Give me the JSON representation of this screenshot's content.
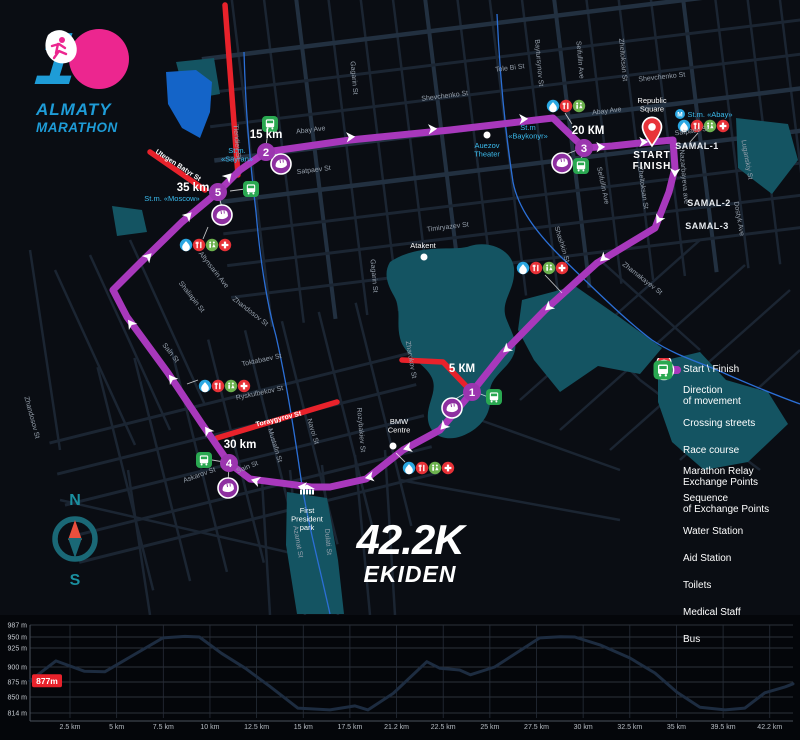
{
  "logo": {
    "number": "1",
    "line1": "ALMATY",
    "line2": "MARATHON"
  },
  "race_title": {
    "distance": "42.2K",
    "name": "EKIDEN"
  },
  "compass": {
    "north": "N",
    "south": "S"
  },
  "legend": {
    "items": [
      {
        "icon": "start-finish-pin",
        "label": "Start \\ Finish"
      },
      {
        "icon": "direction-arrow",
        "label": "Direction\nof movement"
      },
      {
        "icon": "crossing-bar",
        "label": "Crossing streets"
      },
      {
        "icon": "course-bar",
        "label": "Race course"
      },
      {
        "icon": "relay",
        "label": "Marathon Relay\nExchange Points"
      },
      {
        "icon": "sequence",
        "label": "Sequence\nof Exchange Points"
      },
      {
        "icon": "water",
        "label": "Water Station"
      },
      {
        "icon": "aid",
        "label": "Aid Station"
      },
      {
        "icon": "toilets",
        "label": "Toilets"
      },
      {
        "icon": "medical",
        "label": "Medical Staff"
      },
      {
        "icon": "bus",
        "label": "Bus"
      }
    ]
  },
  "map": {
    "start": {
      "x": 652,
      "y": 129,
      "line1": "START",
      "line2": "FINISH"
    },
    "course": {
      "color": "#a838bc",
      "points": [
        [
          673,
          140
        ],
        [
          675,
          168
        ],
        [
          669,
          192
        ],
        [
          655,
          228
        ],
        [
          597,
          263
        ],
        [
          545,
          310
        ],
        [
          503,
          353
        ],
        [
          472,
          392
        ],
        [
          440,
          430
        ],
        [
          403,
          450
        ],
        [
          366,
          479
        ],
        [
          330,
          487
        ],
        [
          311,
          487
        ],
        [
          250,
          479
        ],
        [
          229,
          463
        ],
        [
          202,
          424
        ],
        [
          168,
          373
        ],
        [
          127,
          317
        ],
        [
          113,
          290
        ],
        [
          140,
          263
        ],
        [
          182,
          222
        ],
        [
          218,
          192
        ],
        [
          240,
          170
        ],
        [
          266,
          152
        ],
        [
          350,
          140
        ],
        [
          450,
          130
        ],
        [
          553,
          118
        ],
        [
          584,
          148
        ],
        [
          612,
          146
        ],
        [
          640,
          143
        ],
        [
          673,
          140
        ]
      ],
      "arrows": [
        [
          675,
          172,
          92
        ],
        [
          659,
          219,
          118
        ],
        [
          604,
          258,
          139
        ],
        [
          549,
          307,
          139
        ],
        [
          507,
          349,
          139
        ],
        [
          444,
          426,
          133
        ],
        [
          408,
          448,
          164
        ],
        [
          370,
          477,
          168
        ],
        [
          303,
          487,
          184
        ],
        [
          256,
          481,
          196
        ],
        [
          208,
          431,
          236
        ],
        [
          172,
          379,
          234
        ],
        [
          131,
          324,
          234
        ],
        [
          148,
          257,
          314
        ],
        [
          188,
          216,
          314
        ],
        [
          228,
          177,
          314
        ],
        [
          350,
          137,
          -4
        ],
        [
          432,
          129,
          -4
        ],
        [
          523,
          119,
          -3
        ],
        [
          600,
          147,
          -2
        ],
        [
          643,
          142,
          -1
        ]
      ]
    },
    "crossing_color": "#e8222b",
    "crossing_streets": [
      [
        [
          225,
          5
        ],
        [
          238,
          175
        ]
      ],
      [
        [
          150,
          152
        ],
        [
          205,
          190
        ]
      ],
      [
        [
          402,
          360
        ],
        [
          443,
          362
        ],
        [
          468,
          388
        ]
      ],
      [
        [
          217,
          438
        ],
        [
          337,
          402
        ]
      ]
    ],
    "exchange_points": [
      {
        "n": "1",
        "x": 472,
        "y": 392
      },
      {
        "n": "2",
        "x": 266,
        "y": 152
      },
      {
        "n": "3",
        "x": 584,
        "y": 148
      },
      {
        "n": "4",
        "x": 229,
        "y": 463
      },
      {
        "n": "5",
        "x": 218,
        "y": 192
      }
    ],
    "km_labels": [
      {
        "t": "5 КМ",
        "x": 462,
        "y": 372
      },
      {
        "t": "15 km",
        "x": 266,
        "y": 138
      },
      {
        "t": "20 КМ",
        "x": 588,
        "y": 134
      },
      {
        "t": "30 km",
        "x": 240,
        "y": 448
      },
      {
        "t": "35 km",
        "x": 193,
        "y": 191
      }
    ],
    "relay_points": [
      [
        452,
        408
      ],
      [
        281,
        164
      ],
      [
        562,
        163
      ],
      [
        228,
        488
      ],
      [
        222,
        215
      ]
    ],
    "bus_stops": [
      [
        494,
        397
      ],
      [
        270,
        124
      ],
      [
        581,
        166
      ],
      [
        204,
        460
      ],
      [
        251,
        189
      ]
    ],
    "icon_clusters": [
      {
        "x": 553,
        "y": 106,
        "icons": [
          "water",
          "aid",
          "toilets"
        ]
      },
      {
        "x": 684,
        "y": 126,
        "icons": [
          "water",
          "aid",
          "toilets",
          "medical"
        ]
      },
      {
        "x": 523,
        "y": 268,
        "icons": [
          "water",
          "aid",
          "toilets",
          "medical"
        ]
      },
      {
        "x": 186,
        "y": 245,
        "icons": [
          "water",
          "aid",
          "toilets",
          "medical"
        ]
      },
      {
        "x": 205,
        "y": 386,
        "icons": [
          "water",
          "aid",
          "toilets",
          "medical"
        ]
      },
      {
        "x": 409,
        "y": 468,
        "icons": [
          "water",
          "aid",
          "toilets",
          "medical"
        ]
      }
    ],
    "street_labels": [
      {
        "t": "Tole Bi St",
        "x": 510,
        "y": 70,
        "r": -7
      },
      {
        "t": "Shevchenko St",
        "x": 445,
        "y": 98,
        "r": -7
      },
      {
        "t": "Shevchenko St",
        "x": 662,
        "y": 79,
        "r": -6
      },
      {
        "t": "Abay Ave",
        "x": 311,
        "y": 132,
        "r": -7
      },
      {
        "t": "Abay Ave",
        "x": 607,
        "y": 113,
        "r": -7
      },
      {
        "t": "Satpaev St",
        "x": 314,
        "y": 172,
        "r": -7
      },
      {
        "t": "Satpaev St",
        "x": 692,
        "y": 133,
        "r": -8
      },
      {
        "t": "Timiryazev St",
        "x": 448,
        "y": 229,
        "r": -7
      },
      {
        "t": "Baytursynov St",
        "x": 537,
        "y": 63,
        "r": 85
      },
      {
        "t": "Seifullin Ave",
        "x": 578,
        "y": 60,
        "r": 85
      },
      {
        "t": "Seifullin Ave",
        "x": 601,
        "y": 186,
        "r": 78
      },
      {
        "t": "Zheltoksan St",
        "x": 621,
        "y": 60,
        "r": 85
      },
      {
        "t": "Zheltoksan St",
        "x": 641,
        "y": 188,
        "r": 82
      },
      {
        "t": "Nazarbayeva ave",
        "x": 682,
        "y": 177,
        "r": 85
      },
      {
        "t": "Luganskiy St",
        "x": 745,
        "y": 160,
        "r": 80
      },
      {
        "t": "Dostyk Ave",
        "x": 737,
        "y": 219,
        "r": 80
      },
      {
        "t": "Zhamakayev St",
        "x": 641,
        "y": 280,
        "r": 38
      },
      {
        "t": "Shashkin St",
        "x": 560,
        "y": 245,
        "r": 73
      },
      {
        "t": "Gagarin St",
        "x": 352,
        "y": 78,
        "r": 85
      },
      {
        "t": "Gagarin St",
        "x": 372,
        "y": 276,
        "r": 85
      },
      {
        "t": "Zharokov St",
        "x": 409,
        "y": 360,
        "r": 80
      },
      {
        "t": "Altynsarin Ave",
        "x": 212,
        "y": 271,
        "r": 52
      },
      {
        "t": "Shaliapin St",
        "x": 190,
        "y": 298,
        "r": 52
      },
      {
        "t": "Zhandosov St",
        "x": 249,
        "y": 313,
        "r": 38
      },
      {
        "t": "Zhandosov St",
        "x": 30,
        "y": 418,
        "r": 75
      },
      {
        "t": "Toktabaev St",
        "x": 262,
        "y": 362,
        "r": -12
      },
      {
        "t": "Sain St",
        "x": 169,
        "y": 354,
        "r": 52
      },
      {
        "t": "Sain St",
        "x": 248,
        "y": 469,
        "r": -22
      },
      {
        "t": "Askarov St",
        "x": 200,
        "y": 477,
        "r": -20
      },
      {
        "t": "Ryskulbekov St",
        "x": 260,
        "y": 395,
        "r": -12
      },
      {
        "t": "Mustafin St",
        "x": 273,
        "y": 446,
        "r": 73
      },
      {
        "t": "Navoi St",
        "x": 311,
        "y": 432,
        "r": 73
      },
      {
        "t": "Rozybakiev St",
        "x": 359,
        "y": 430,
        "r": 85
      },
      {
        "t": "Azamat St",
        "x": 296,
        "y": 542,
        "r": 80
      },
      {
        "t": "Dulati St",
        "x": 326,
        "y": 542,
        "r": 85
      },
      {
        "t": "Tlendiev St",
        "x": 235,
        "y": 142,
        "r": 85
      },
      {
        "t": "Utegen Batyr St",
        "x": 177,
        "y": 167,
        "r": 33,
        "red": true
      },
      {
        "t": "Toraygyrov St",
        "x": 279,
        "y": 421,
        "r": -14,
        "red": true
      }
    ],
    "metro_labels": [
      {
        "t": "St.m.\n«Sayran»",
        "x": 237,
        "y": 153
      },
      {
        "t": "St.m. «Moscow»",
        "x": 172,
        "y": 201
      },
      {
        "t": "St.m\n«Baykonyr»",
        "x": 528,
        "y": 130
      },
      {
        "t": "St.m. «Abay»",
        "x": 710,
        "y": 117,
        "mdot": [
          680,
          114
        ]
      },
      {
        "t": "Auezov\nTheater",
        "x": 487,
        "y": 148,
        "wdot": [
          487,
          135
        ]
      }
    ],
    "poi_labels": [
      {
        "t": "Republic\nSquare",
        "x": 652,
        "y": 103
      },
      {
        "t": "Atakent",
        "x": 423,
        "y": 248,
        "wdot": [
          424,
          257
        ]
      },
      {
        "t": "BMW\nCentre",
        "x": 399,
        "y": 424,
        "wdot": [
          393,
          446
        ]
      },
      {
        "t": "First\nPresident\npark",
        "x": 307,
        "y": 513,
        "building": [
          307,
          489
        ]
      }
    ],
    "area_labels": [
      {
        "t": "SAMAL-1",
        "x": 697,
        "y": 149
      },
      {
        "t": "SAMAL-2",
        "x": 709,
        "y": 206
      },
      {
        "t": "SAMAL-3",
        "x": 707,
        "y": 229
      }
    ]
  },
  "chart_data": {
    "type": "line",
    "description": "Elevation profile of the 42.2 km Ekiden course",
    "ylabel": "elevation (m)",
    "xlabel": "distance (km)",
    "y_ticks": [
      "987 m",
      "950 m",
      "925 m",
      "900 m",
      "875 m",
      "850 m",
      "814 m"
    ],
    "y_tick_values": [
      987,
      950,
      925,
      900,
      875,
      850,
      814
    ],
    "x_ticks": [
      "2.5 km",
      "5 km",
      "7.5 km",
      "10 km",
      "12.5 km",
      "15 km",
      "17.5 km",
      "21.2 km",
      "22.5 km",
      "25 km",
      "27.5 km",
      "30 km",
      "32.5 km",
      "35 km",
      "39.5 km",
      "42.2 km"
    ],
    "start_elevation_label": "877m",
    "profile": [
      [
        0,
        877
      ],
      [
        0.034,
        908
      ],
      [
        0.071,
        893
      ],
      [
        0.098,
        892
      ],
      [
        0.174,
        948
      ],
      [
        0.203,
        952
      ],
      [
        0.222,
        950
      ],
      [
        0.251,
        918
      ],
      [
        0.282,
        898
      ],
      [
        0.314,
        868
      ],
      [
        0.351,
        825
      ],
      [
        0.393,
        821
      ],
      [
        0.426,
        830
      ],
      [
        0.443,
        821
      ],
      [
        0.476,
        856
      ],
      [
        0.52,
        907
      ],
      [
        0.537,
        898
      ],
      [
        0.563,
        895
      ],
      [
        0.577,
        887
      ],
      [
        0.609,
        900
      ],
      [
        0.668,
        948
      ],
      [
        0.695,
        951
      ],
      [
        0.714,
        950
      ],
      [
        0.747,
        932
      ],
      [
        0.786,
        912
      ],
      [
        0.819,
        890
      ],
      [
        0.848,
        858
      ],
      [
        0.878,
        827
      ],
      [
        0.911,
        821
      ],
      [
        0.937,
        825
      ],
      [
        0.963,
        857
      ],
      [
        0.99,
        867
      ],
      [
        1,
        872
      ]
    ]
  },
  "colors": {
    "course": "#a838bc",
    "crossing": "#e8222b",
    "water": "#2aa7e2",
    "aid": "#e73137",
    "toilets": "#6cb24e",
    "medical": "#e73137",
    "bus": "#2aa851",
    "exchange": "#9b35af",
    "relay": "#8d2fa0",
    "metro_text": "#3bbcee",
    "park": "#145462",
    "lake": "#1464c8",
    "river": "#2b6fd6",
    "logo_blue": "#1e9cd7",
    "logo_pink": "#ec268f"
  }
}
